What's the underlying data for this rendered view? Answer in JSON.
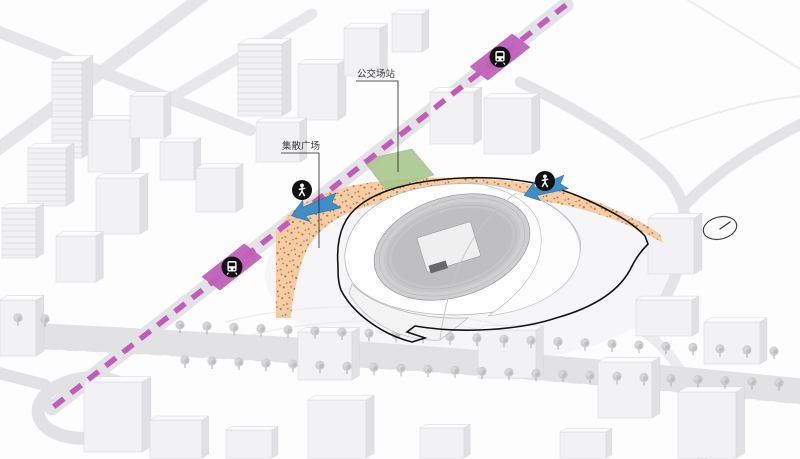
{
  "labels": {
    "bus_station": "公交场站",
    "gathering_plaza": "集散广场"
  },
  "colors": {
    "metro_line": "#c25cba",
    "metro_station": "#c05fbc",
    "pedestrian_arrow": "#3f8ec8",
    "plaza_fill": "#f6c9a0",
    "plaza_dots": "#b0651e",
    "bus_depot_green": "#a8c78d",
    "site_outline": "#141414"
  },
  "icons": {
    "metro_station": "metro-train-icon",
    "pedestrian": "pedestrian-icon",
    "north_indicator": "compass-icon"
  }
}
